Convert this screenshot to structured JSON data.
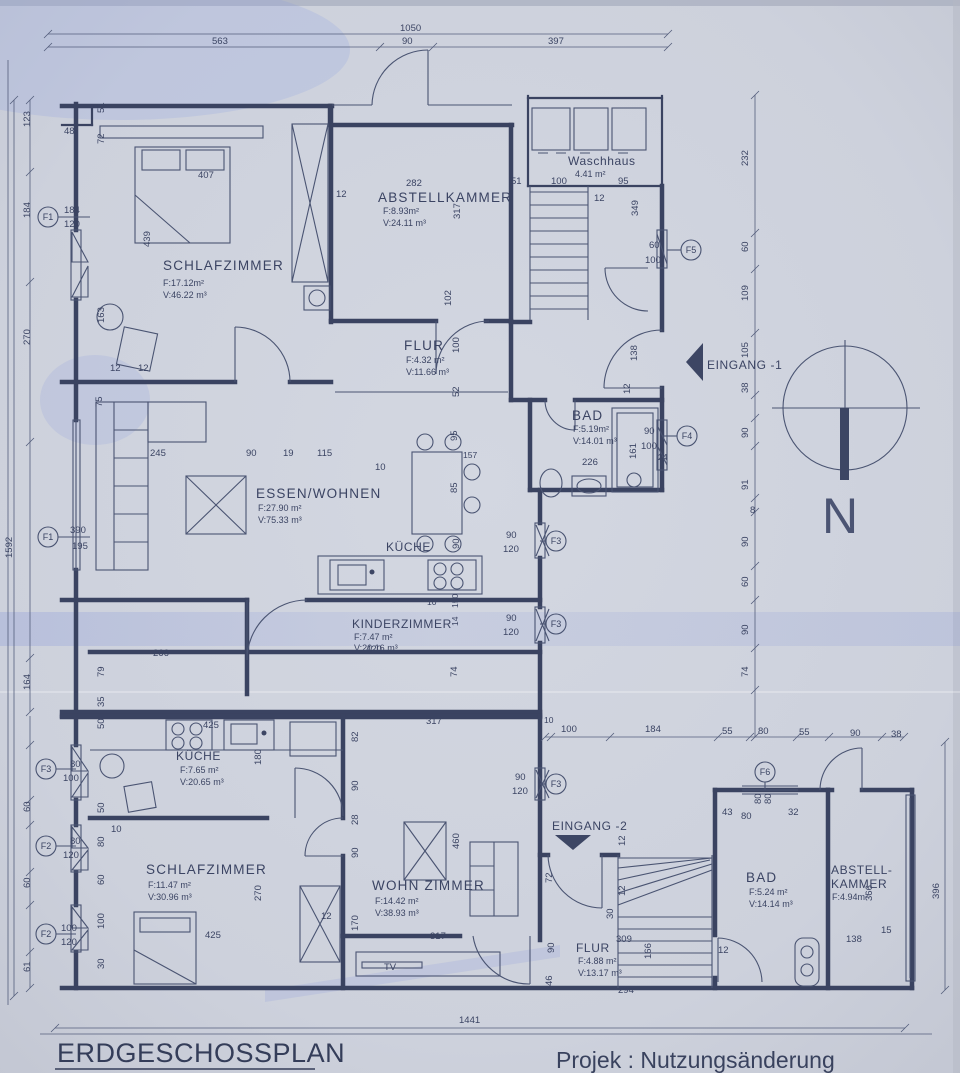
{
  "title": "ERDGESCHOSSPLAN",
  "project": "Projek : Nutzungsänderung",
  "compass": {
    "north": "N"
  },
  "entrances": {
    "e1": "EINGANG -1",
    "e2": "EINGANG -2"
  },
  "labels": {
    "tv": "TV"
  },
  "rooms": {
    "schlaf1": {
      "name": "SCHLAFZIMMER",
      "area": "F:17.12m²",
      "vol": "V:46.22 m³"
    },
    "abstell1": {
      "name": "ABSTELLKAMMER",
      "area": "F:8.93m²",
      "vol": "V:24.11 m³"
    },
    "waschhaus": {
      "name": "Waschhaus",
      "area": "4.41 m²"
    },
    "flur1": {
      "name": "FLUR",
      "area": "F:4.32 m²",
      "vol": "V:11.66 m³"
    },
    "bad1": {
      "name": "BAD",
      "area": "F:5.19m²",
      "vol": "V:14.01 m³"
    },
    "essen": {
      "name": "ESSEN/WOHNEN",
      "area": "F:27.90 m²",
      "vol": "V:75.33 m³"
    },
    "kueche1": {
      "name": "KÜCHE"
    },
    "kinder": {
      "name": "KINDERZIMMER",
      "area": "F:7.47 m²",
      "vol": "V:20.16 m³"
    },
    "kueche2": {
      "name": "KÜCHE",
      "area": "F:7.65 m²",
      "vol": "V:20.65 m³"
    },
    "schlaf2": {
      "name": "SCHLAFZIMMER",
      "area": "F:11.47 m²",
      "vol": "V:30.96 m³"
    },
    "wohn": {
      "name": "WOHN ZIMMER",
      "area": "F:14.42 m²",
      "vol": "V:38.93 m³"
    },
    "flur2": {
      "name": "FLUR",
      "area": "F:4.88 m²",
      "vol": "V:13.17 m³"
    },
    "bad2": {
      "name": "BAD",
      "area": "F:5.24 m²",
      "vol": "V:14.14 m³"
    },
    "abstell2": {
      "name1": "ABSTELL-",
      "name2": "KAMMER",
      "area": "F:4.94m²"
    }
  },
  "markers": [
    "F1",
    "F1",
    "F2",
    "F2",
    "F3",
    "F3",
    "F3",
    "F3",
    "F4",
    "F5",
    "F6"
  ],
  "dims": {
    "top": [
      "1050",
      "563",
      "90",
      "397"
    ],
    "left": [
      "1592",
      "123",
      "184",
      "270",
      "164",
      "60",
      "60",
      "61"
    ],
    "leftwin": [
      "184",
      "120",
      "390",
      "195",
      "80",
      "100",
      "80",
      "120",
      "100",
      "120"
    ],
    "leftinner": [
      "51",
      "72",
      "163",
      "75",
      "79",
      "35",
      "50",
      "50",
      "10",
      "80",
      "60",
      "100",
      "30",
      "48",
      "12",
      "12"
    ],
    "schlaf1": [
      "407",
      "439"
    ],
    "abstell1": [
      "282",
      "12",
      "51",
      "317",
      "102"
    ],
    "wasch": [
      "100",
      "95",
      "12",
      "349",
      "60",
      "100"
    ],
    "right": [
      "232",
      "60",
      "109",
      "105",
      "38",
      "90",
      "91",
      "8",
      "90",
      "60",
      "90",
      "74"
    ],
    "flur1": [
      "100",
      "52"
    ],
    "eingang1": [
      "138",
      "12"
    ],
    "bad1": [
      "90",
      "100",
      "226",
      "161",
      "24"
    ],
    "essen": [
      "245",
      "90",
      "19",
      "115",
      "10",
      "157",
      "95",
      "85",
      "90"
    ],
    "f3mid": [
      "90",
      "120",
      "90",
      "120"
    ],
    "f3right": [
      "90",
      "120"
    ],
    "kinder": [
      "10",
      "150",
      "14",
      "266",
      "420",
      "74"
    ],
    "kueche2": [
      "425",
      "180",
      "82",
      "90",
      "28"
    ],
    "schlaf2": [
      "425",
      "270",
      "170",
      "12",
      "90"
    ],
    "wohn": [
      "460",
      "317",
      "317"
    ],
    "bot": [
      "10",
      "100",
      "184",
      "55",
      "80",
      "55",
      "90",
      "38"
    ],
    "flur2": [
      "72",
      "90",
      "12",
      "12",
      "30",
      "309",
      "166",
      "294",
      "46"
    ],
    "bad2": [
      "43",
      "80",
      "32",
      "80",
      "80",
      "12"
    ],
    "abstell2": [
      "366",
      "396",
      "138",
      "15"
    ],
    "bottom": [
      "1441"
    ]
  }
}
